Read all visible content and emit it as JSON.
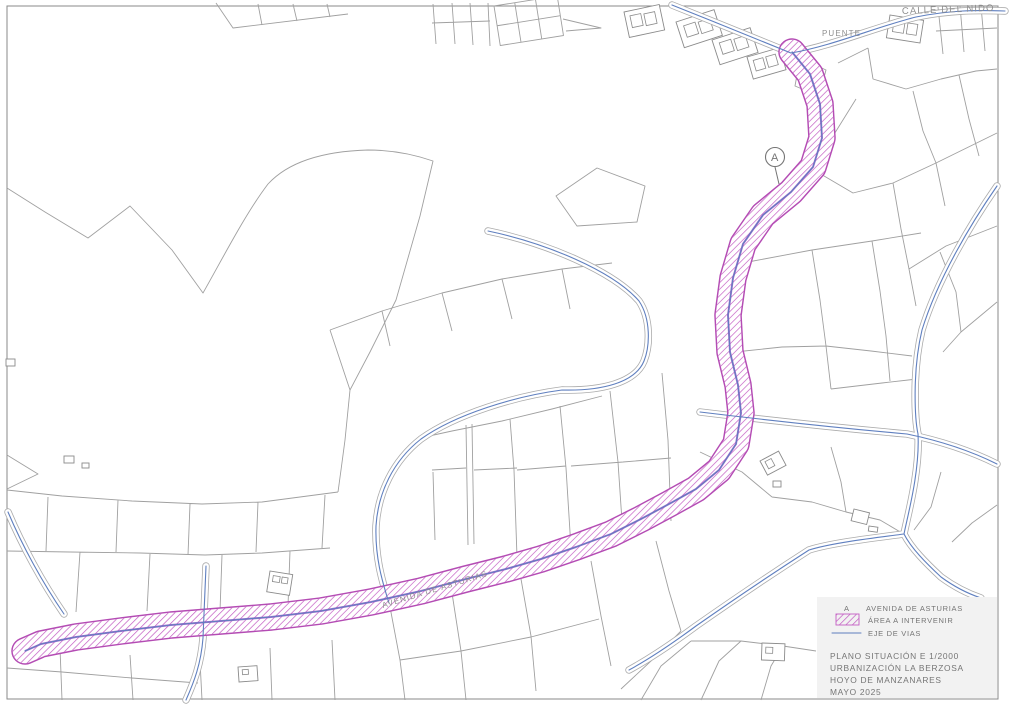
{
  "map": {
    "labels": {
      "calle_del_nido": "CALLE DEL NIDO",
      "puente": "PUENTE",
      "avenida_de_asturias": "AVENIDA DE ASTURIAS",
      "marker_a": "A"
    }
  },
  "legend": {
    "avenida_symbol": "A",
    "avenida_label": "AVENIDA DE ASTURIAS",
    "area_label": "ÁREA A INTERVENIR",
    "eje_label": "EJE DE VIAS",
    "title_lines": [
      "PLANO SITUACIÓN E 1/2000",
      "URBANIZACIÓN LA BERZOSA",
      "HOYO DE MANZANARES",
      "MAYO 2025"
    ]
  },
  "colors": {
    "paper": "#ffffff",
    "parcel-line": "#a0a0a0",
    "building-line": "#8b8b8b",
    "road-casing": "#ababab",
    "eje-blue": "#5f7fbf",
    "area-magenta": "#c45ec4",
    "area-edge": "#b44cb4",
    "area-center": "#9a55c8",
    "text-gray": "#757575",
    "label-gray": "#8f8f8f",
    "panel-bg": "#f2f2f2",
    "border-gray": "#8a8a8a"
  }
}
